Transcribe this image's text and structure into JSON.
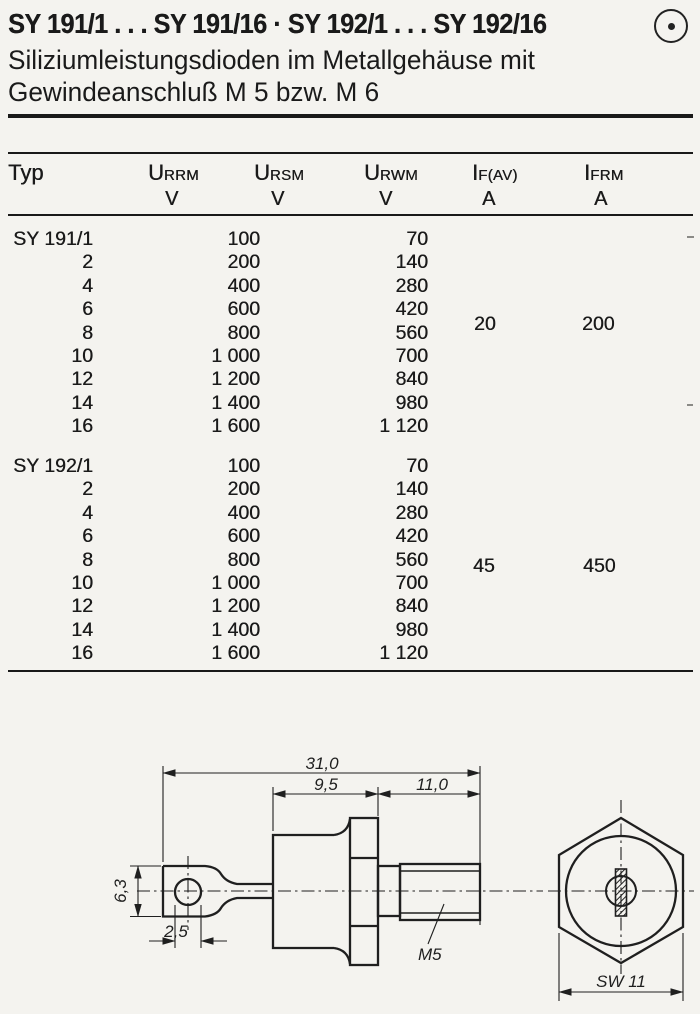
{
  "header": {
    "title": "SY 191/1 . . . SY 191/16 · SY 192/1 . . . SY 192/16",
    "logo_icon": "circled-dot-icon",
    "subtitle_line1": "Siliziumleistungsdioden im Metallgehäuse mit",
    "subtitle_line2": "Gewindeanschluß M 5 bzw. M 6"
  },
  "table": {
    "header": {
      "typ": "Typ",
      "urrm": {
        "sym": "U",
        "sub": "RRM",
        "unit": "V"
      },
      "ursm": {
        "sym": "U",
        "sub": "RSM",
        "unit": "V"
      },
      "urwm": {
        "sym": "U",
        "sub": "RWM",
        "unit": "V"
      },
      "ifav": {
        "sym": "I",
        "sub": "F(AV)",
        "unit": "A"
      },
      "ifrm": {
        "sym": "I",
        "sub": "FRM",
        "unit": "A"
      }
    },
    "groups": [
      {
        "name": "SY 191",
        "if_av": "20",
        "ifrm": "200",
        "rows": [
          {
            "typ": "SY 191/1",
            "urrm": "100",
            "urwm": "70"
          },
          {
            "typ": "2",
            "urrm": "200",
            "urwm": "140"
          },
          {
            "typ": "4",
            "urrm": "400",
            "urwm": "280"
          },
          {
            "typ": "6",
            "urrm": "600",
            "urwm": "420"
          },
          {
            "typ": "8",
            "urrm": "800",
            "urwm": "560"
          },
          {
            "typ": "10",
            "urrm": "1 000",
            "urwm": "700"
          },
          {
            "typ": "12",
            "urrm": "1 200",
            "urwm": "840"
          },
          {
            "typ": "14",
            "urrm": "1 400",
            "urwm": "980"
          },
          {
            "typ": "16",
            "urrm": "1 600",
            "urwm": "1 120"
          }
        ]
      },
      {
        "name": "SY 192",
        "if_av": "45",
        "ifrm": "450",
        "rows": [
          {
            "typ": "SY 192/1",
            "urrm": "100",
            "urwm": "70"
          },
          {
            "typ": "2",
            "urrm": "200",
            "urwm": "140"
          },
          {
            "typ": "4",
            "urrm": "400",
            "urwm": "280"
          },
          {
            "typ": "6",
            "urrm": "600",
            "urwm": "420"
          },
          {
            "typ": "8",
            "urrm": "800",
            "urwm": "560"
          },
          {
            "typ": "10",
            "urrm": "1 000",
            "urwm": "700"
          },
          {
            "typ": "12",
            "urrm": "1 200",
            "urwm": "840"
          },
          {
            "typ": "14",
            "urrm": "1 400",
            "urwm": "980"
          },
          {
            "typ": "16",
            "urrm": "1 600",
            "urwm": "1 120"
          }
        ]
      }
    ]
  },
  "drawing": {
    "dims": {
      "overall_length": "31,0",
      "case_length": "9,5",
      "stud_length": "11,0",
      "lug_width": "6,3",
      "hole_diameter": "2,5",
      "thread": "M5",
      "wrench_size": "SW 11"
    }
  }
}
